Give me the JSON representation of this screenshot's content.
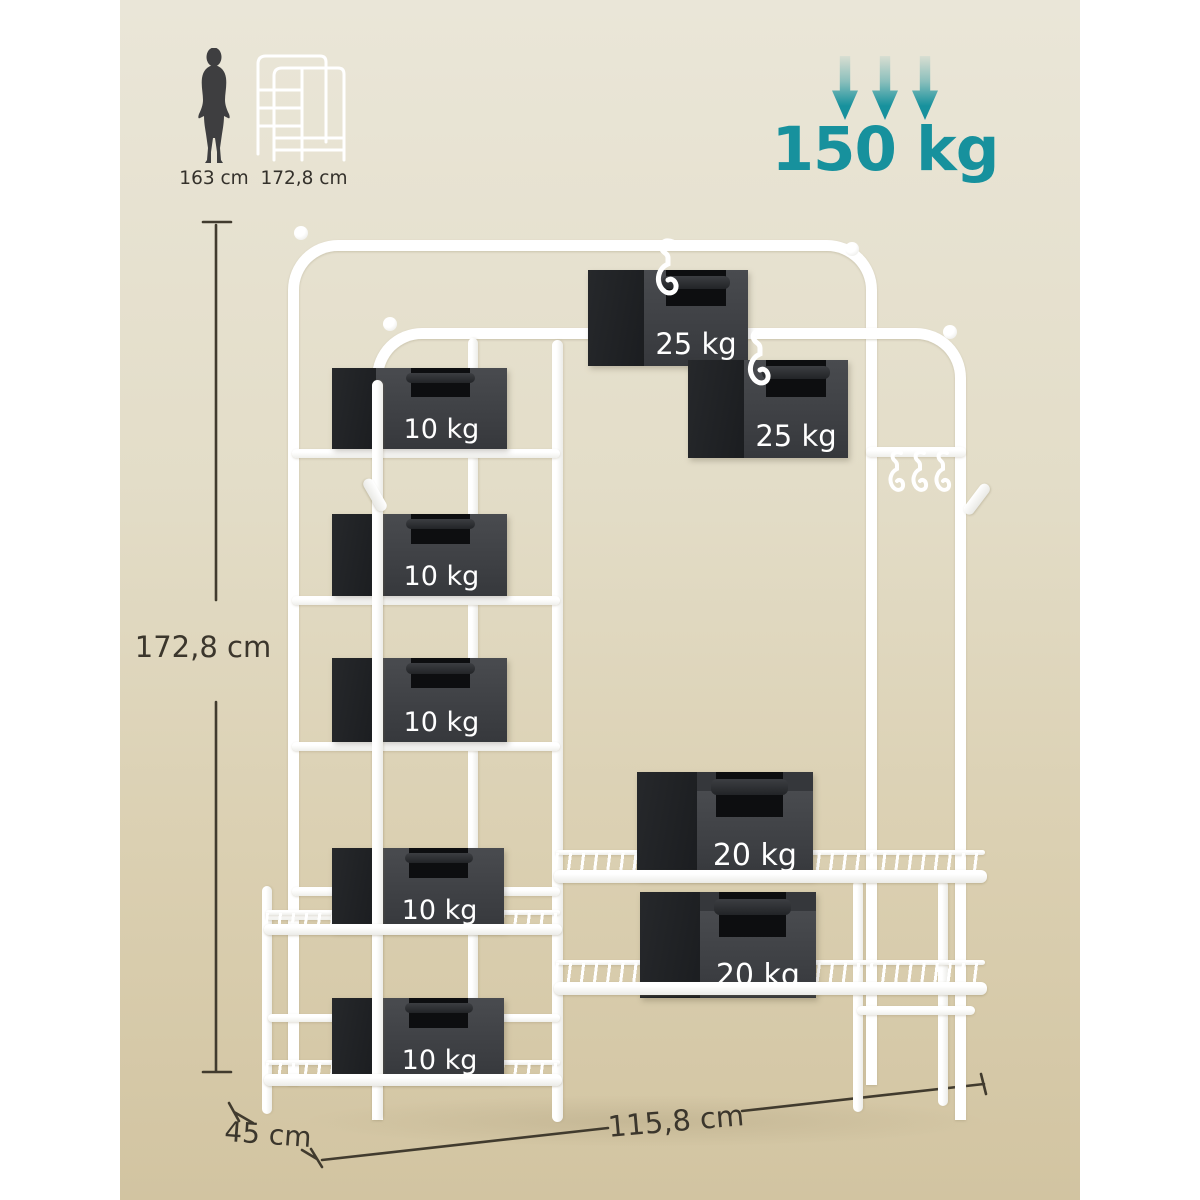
{
  "reference": {
    "person_label": "163 cm",
    "rack_label": "172,8 cm"
  },
  "capacity": {
    "label": "150 kg"
  },
  "dimensions": {
    "height": "172,8 cm",
    "depth": "45 cm",
    "width": "115,8 cm"
  },
  "weights": {
    "hanging": [
      {
        "label": "25 kg"
      },
      {
        "label": "25 kg"
      }
    ],
    "shelf": [
      {
        "label": "10 kg"
      },
      {
        "label": "10 kg"
      },
      {
        "label": "10 kg"
      },
      {
        "label": "10 kg"
      },
      {
        "label": "10 kg"
      }
    ],
    "bench": [
      {
        "label": "20 kg"
      },
      {
        "label": "20 kg"
      }
    ]
  },
  "colors": {
    "accent_teal": "#17919d",
    "backdrop_top": "#eae6d8",
    "backdrop_bottom": "#d2c4a1",
    "frame_white": "#ffffff",
    "weight_front": "#3f4145",
    "weight_side": "#1d1f21",
    "dim_line": "#413b2e",
    "silhouette": "#3e3e40"
  }
}
